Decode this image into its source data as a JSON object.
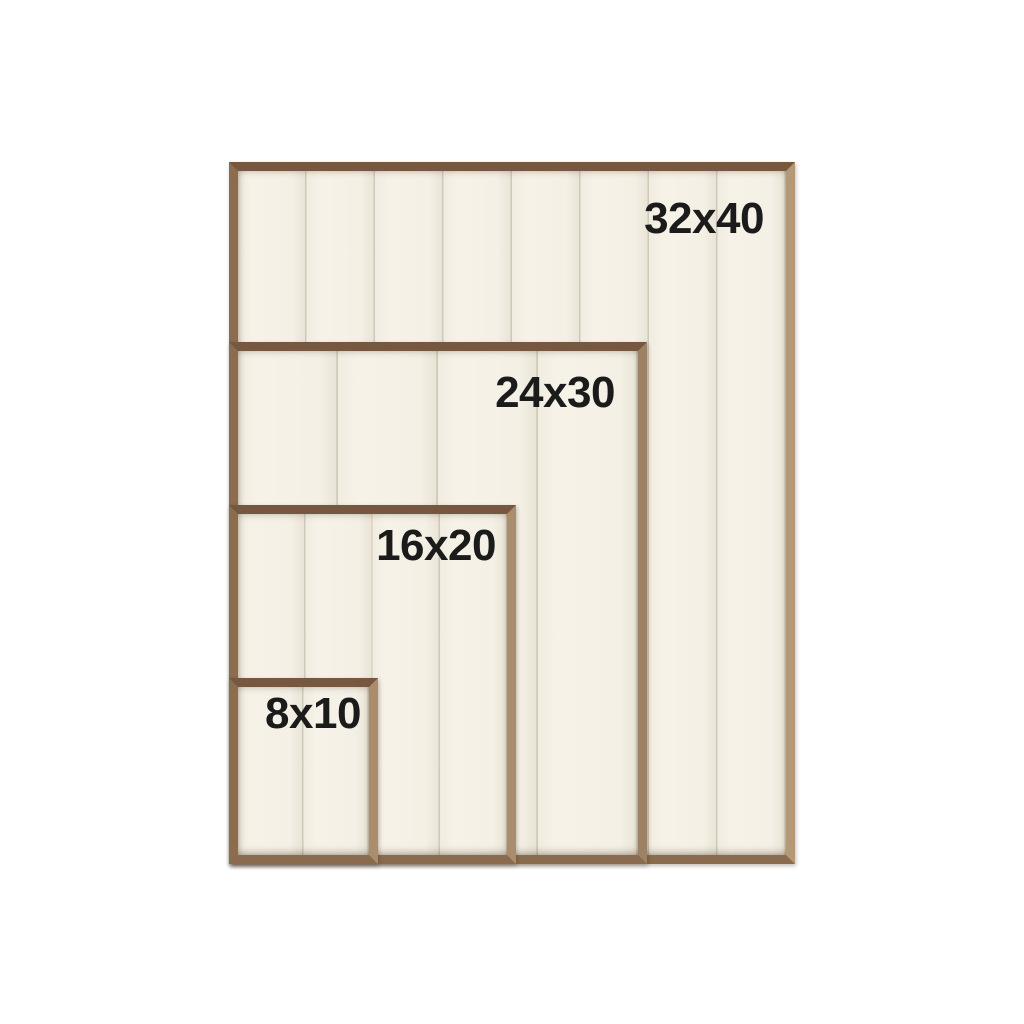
{
  "frames": [
    {
      "id": "32x40",
      "label": "32x40"
    },
    {
      "id": "24x30",
      "label": "24x30"
    },
    {
      "id": "16x20",
      "label": "16x20"
    },
    {
      "id": "8x10",
      "label": "8x10"
    }
  ],
  "colors": {
    "background": "#ffffff",
    "wood_top": "#76573f",
    "wood_right": "#ab8d6b",
    "wood_bottom": "#8a6b4d",
    "wood_left": "#8c6c4e",
    "panel_cream": "#f4f0e5",
    "plank_divider": "#cfc9b9",
    "label_text": "#1b1b1b"
  }
}
